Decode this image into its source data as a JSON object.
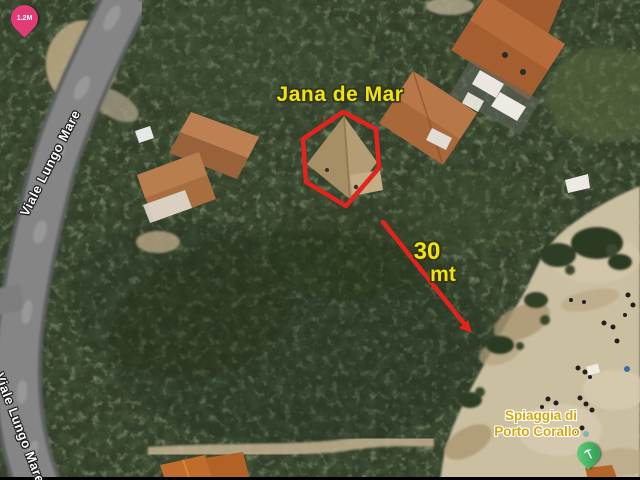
{
  "map": {
    "annotations": {
      "property_label": "Jana de Mar",
      "distance_value": "30",
      "distance_unit": "mt",
      "outline_shape": "hexagon"
    },
    "road_labels": [
      "Viale Lungo Mare",
      "Viale Lungo Mare"
    ],
    "poi": {
      "beach_label_line1": "Spiaggia di",
      "beach_label_line2": "Porto Corallo",
      "beach_pin_icon": "beach-umbrella-icon"
    },
    "price_pin": {
      "label": "1.2M",
      "icon": "map-pin-icon"
    },
    "colors": {
      "annotation_red": "#e3231d",
      "annotation_yellow": "#eee316",
      "road_label_text": "#ffffff",
      "beach_label_yellow": "#d2a80e",
      "price_pin_pink": "#e23b76",
      "beach_pin_green": "#35a656"
    }
  }
}
